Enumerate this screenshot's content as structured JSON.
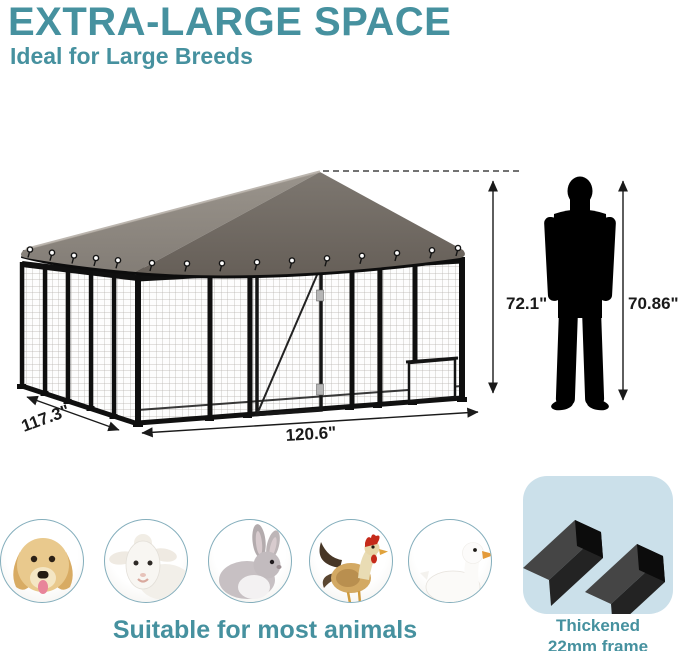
{
  "header": {
    "title": "EXTRA-LARGE SPACE",
    "subtitle": "Ideal for Large Breeds"
  },
  "dimensions": {
    "depth": "117.3\"",
    "width": "120.6\"",
    "kennel_height": "72.1\"",
    "person_height": "70.86\""
  },
  "animals": {
    "caption": "Suitable for most animals",
    "icons": [
      "dog-icon",
      "sheep-icon",
      "rabbit-icon",
      "rooster-icon",
      "duck-icon"
    ]
  },
  "feature": {
    "line1": "Thickened",
    "line2": "22mm frame"
  },
  "colors": {
    "accent": "#46919f",
    "dimension_text": "#1a1a1a",
    "roof_light": "#8e8780",
    "roof_dark": "#6e6861",
    "frame_metal": "#141414",
    "card_background": "#cbe0ea",
    "circle_border": "#84aebc"
  }
}
